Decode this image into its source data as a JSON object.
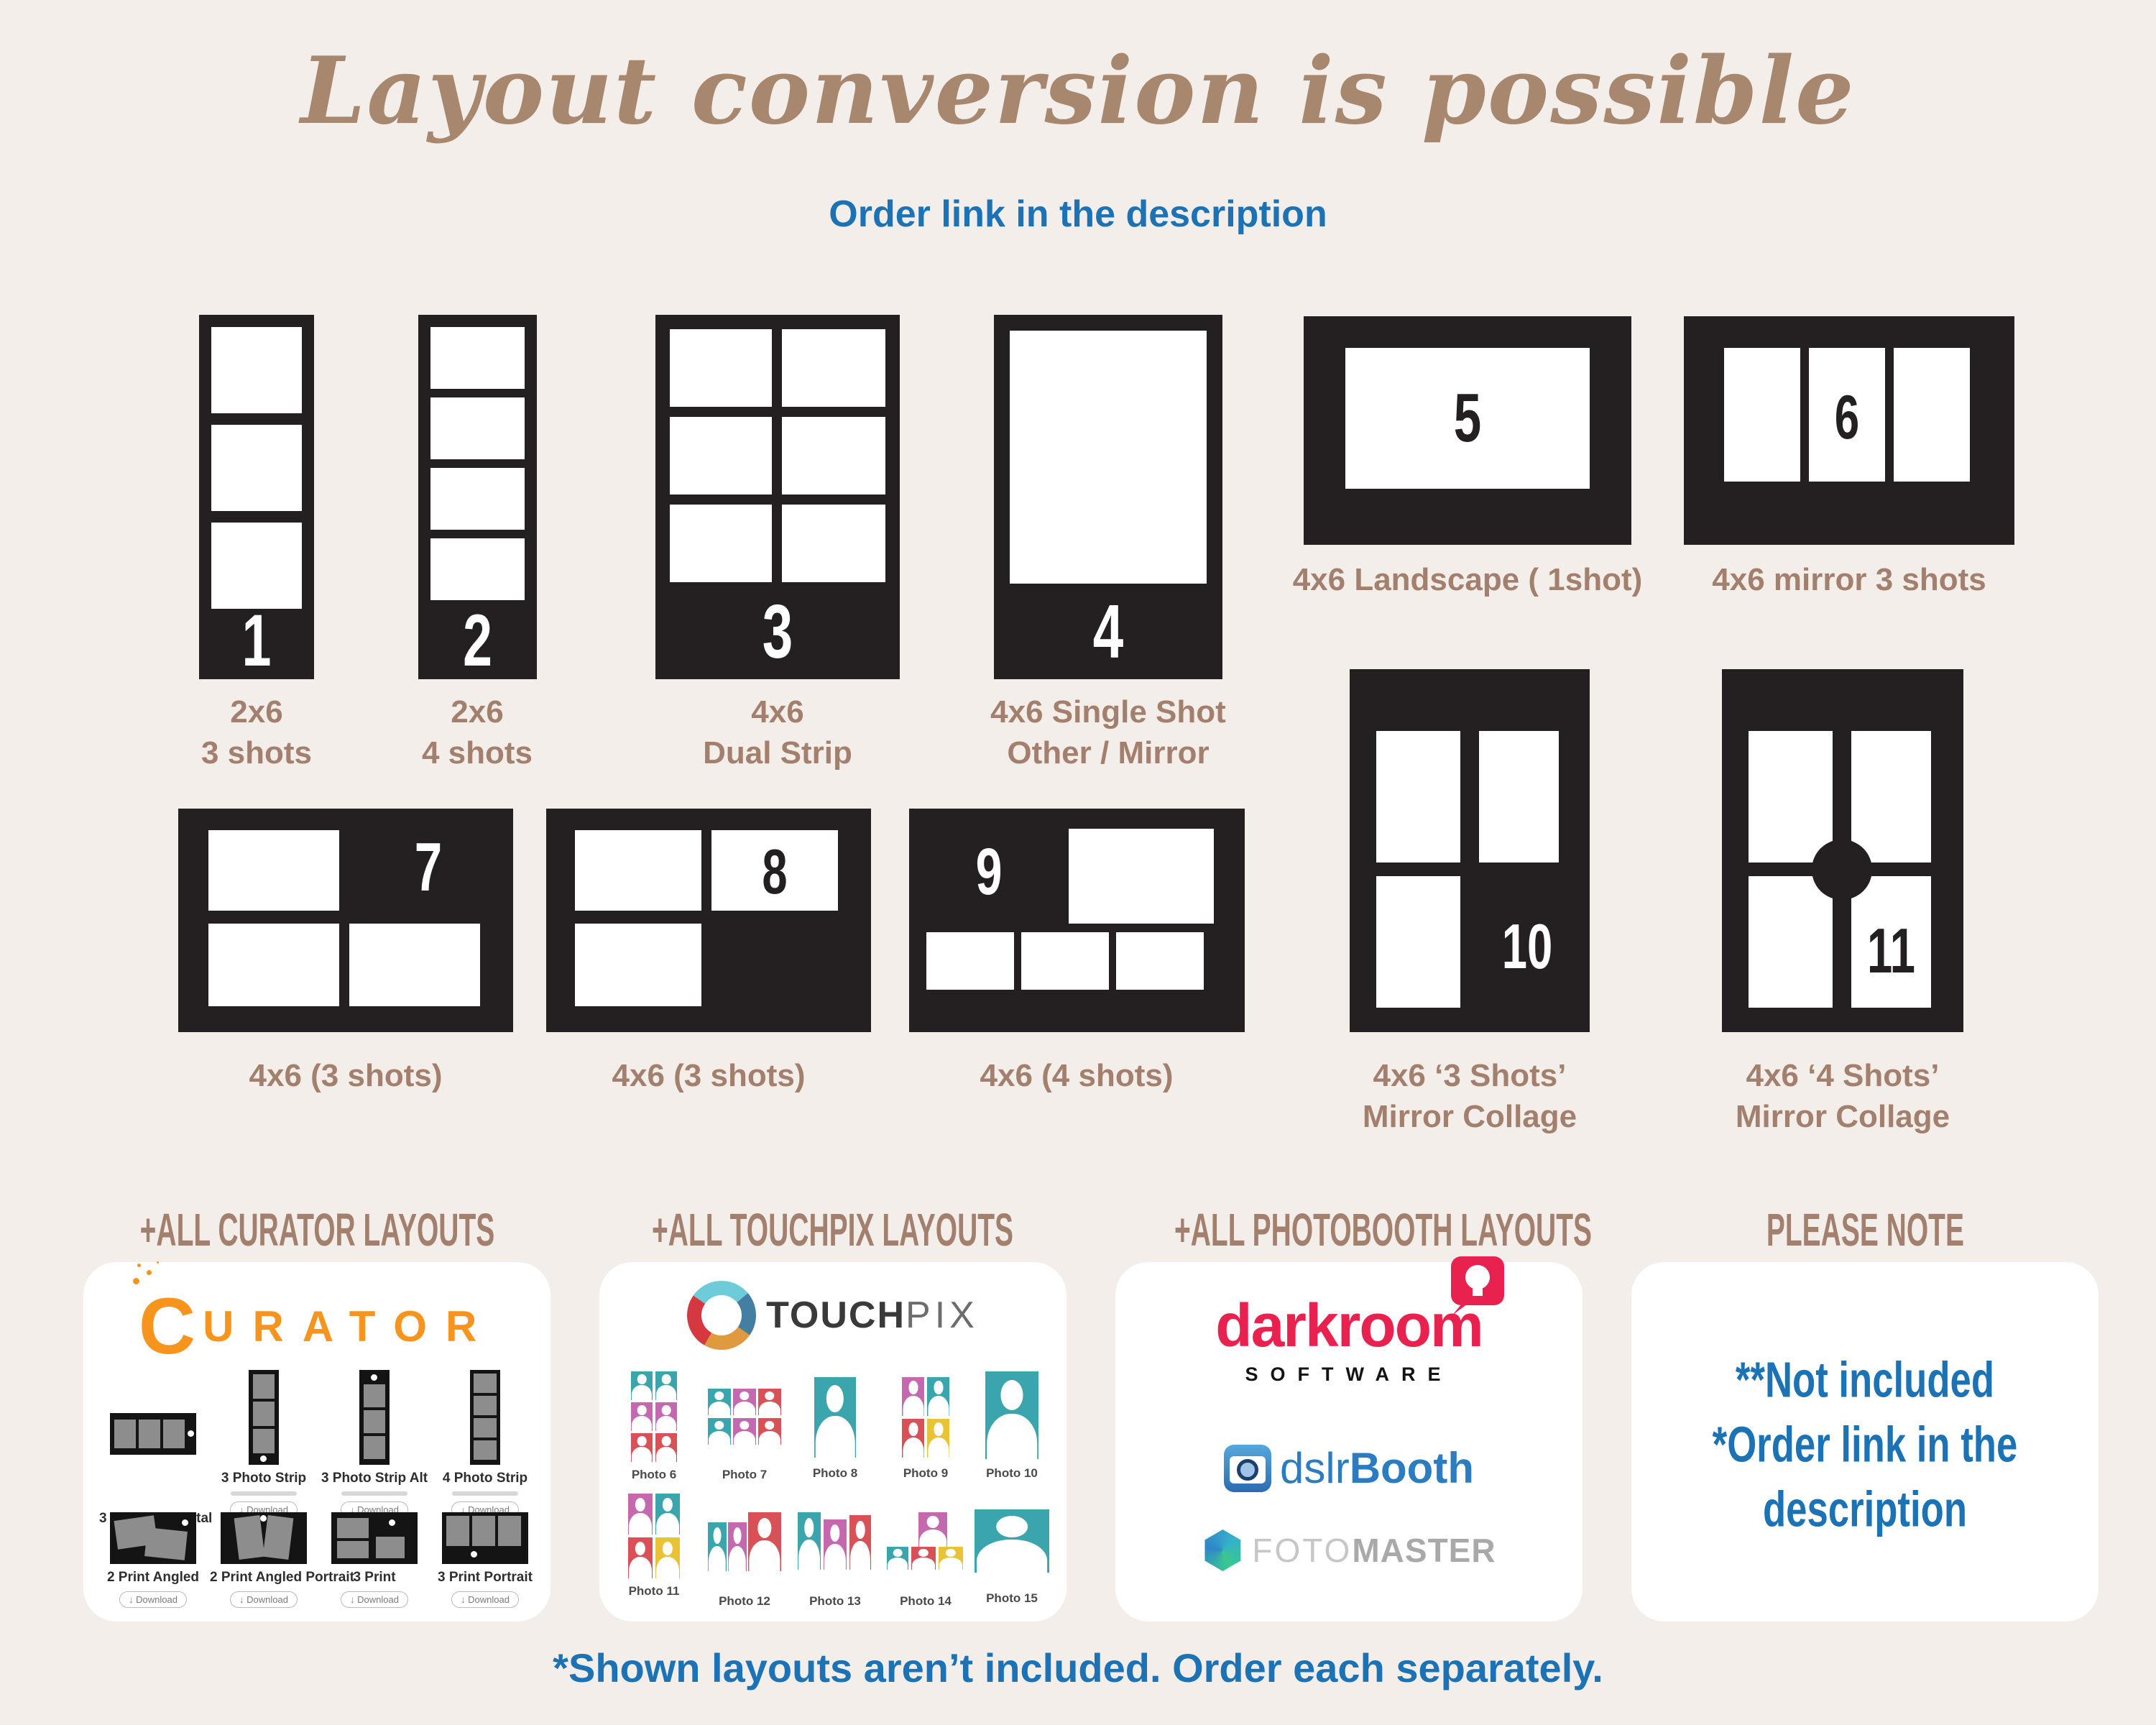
{
  "header": {
    "title": "Layout conversion is possible",
    "subtitle": "Order link in the description"
  },
  "layouts": [
    {
      "num": "1",
      "lines": [
        "2x6",
        "3 shots"
      ]
    },
    {
      "num": "2",
      "lines": [
        "2x6",
        "4 shots"
      ]
    },
    {
      "num": "3",
      "lines": [
        "4x6",
        "Dual Strip"
      ]
    },
    {
      "num": "4",
      "lines": [
        "4x6 Single Shot",
        "Other / Mirror"
      ]
    },
    {
      "num": "5",
      "lines": [
        "4x6 Landscape ( 1shot)"
      ]
    },
    {
      "num": "6",
      "lines": [
        "4x6 mirror 3 shots"
      ]
    },
    {
      "num": "7",
      "lines": [
        "4x6 (3 shots)"
      ]
    },
    {
      "num": "8",
      "lines": [
        "4x6 (3 shots)"
      ]
    },
    {
      "num": "9",
      "lines": [
        "4x6 (4 shots)"
      ]
    },
    {
      "num": "10",
      "lines": [
        "4x6 ‘3 Shots’",
        "Mirror Collage"
      ]
    },
    {
      "num": "11",
      "lines": [
        "4x6 ‘4 Shots’",
        "Mirror Collage"
      ]
    }
  ],
  "sections": {
    "curator": {
      "heading": "+ALL CURATOR LAYOUTS",
      "brand_initial": "C",
      "brand_rest": "URATOR",
      "download_label": "Download",
      "items": [
        {
          "label": "3 Strip Horizontal"
        },
        {
          "label": "3 Photo Strip"
        },
        {
          "label": "3 Photo Strip Alt"
        },
        {
          "label": "4 Photo Strip"
        },
        {
          "label": "2 Print Angled"
        },
        {
          "label": "2 Print Angled Portrait"
        },
        {
          "label": "3 Print"
        },
        {
          "label": "3 Print Portrait"
        }
      ]
    },
    "touchpix": {
      "heading": "+ALL TOUCHPIX LAYOUTS",
      "brand_bold": "TOUCH",
      "brand_light": "PIX",
      "photos": [
        "Photo 6",
        "Photo 7",
        "Photo 8",
        "Photo 9",
        "Photo 10",
        "Photo 11",
        "Photo 12",
        "Photo 13",
        "Photo 14",
        "Photo 15"
      ]
    },
    "photobooth": {
      "heading": "+ALL PHOTOBOOTH LAYOUTS",
      "darkroom": "darkroom",
      "software": "SOFTWARE",
      "dslr_thin": "dslr",
      "dslr_bold": "Booth",
      "foto": "FOTO",
      "master": "MASTER"
    },
    "note": {
      "heading": "PLEASE NOTE",
      "lines": [
        "**Not included",
        "*Order link in the",
        "description"
      ]
    }
  },
  "footer": {
    "text": "*Shown layouts aren’t included. Order each separately."
  },
  "colors": {
    "background": "#f4eeea",
    "frame": "#241f20",
    "label_brown": "#a3806d",
    "title_brown": "#a8876f",
    "accent_blue": "#1b73b6",
    "curator_orange": "#f7941e",
    "darkroom_pink": "#e8214f",
    "dslr_blue": "#2b7cc0",
    "touchpix_teal": "#3aa5ad",
    "touchpix_magenta": "#c468af",
    "touchpix_red": "#d95156",
    "touchpix_yellow": "#e9c235"
  }
}
